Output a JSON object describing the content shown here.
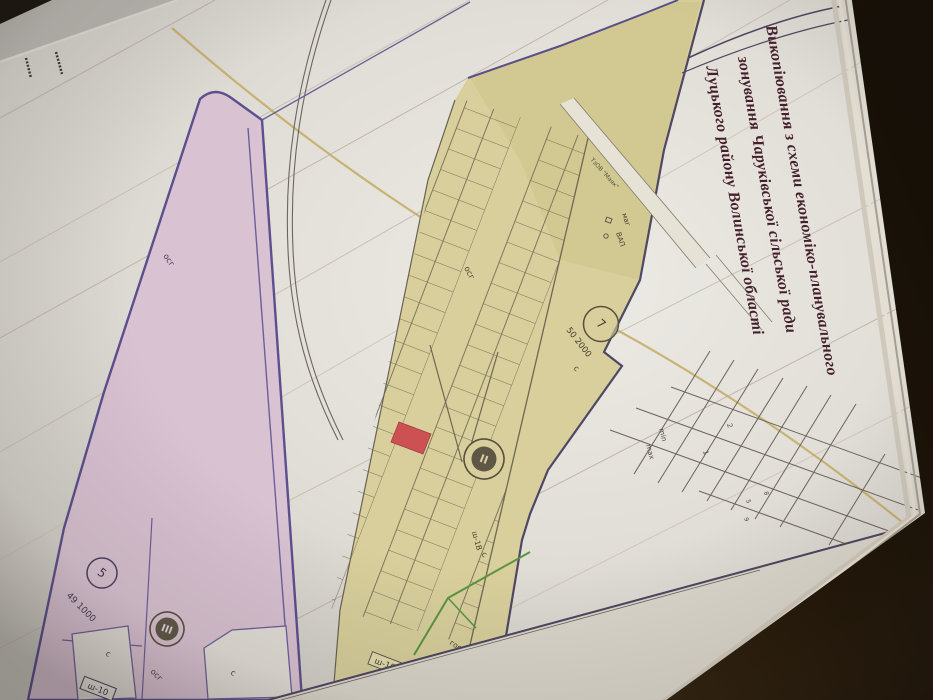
{
  "photo": {
    "table_color": "#21160b",
    "paper_color": "#e7e4de"
  },
  "title_block": {
    "line1": "Викопіювання з схеми економіко-планувального",
    "line2": "зонування Чаруківської сільської ради",
    "line3": "Луцького району Волинської області",
    "text_color": "#44202c"
  },
  "zones": {
    "residential_strip": {
      "fill": "#d9c2d2",
      "border": "#5c4f8e",
      "zone_circle": "5",
      "zone_area": "49 1000",
      "district_circle": "III",
      "labels": {
        "osg_upper": "осг",
        "osg_lower": "осг",
        "parcel_c_left": "с",
        "parcel_c_right": "с",
        "road_box": "ш-10"
      }
    },
    "agricultural_zone": {
      "fill": "#d8cf9c",
      "border": "#554a72",
      "zone_circle": "7",
      "zone_area": "50 2000",
      "district_circle": "II",
      "highlight_parcel_color": "#cd5152",
      "labels": {
        "osg": "осг",
        "c_upper": "с",
        "c_lower": "с",
        "road_box": "ш-10",
        "road_sh1v": "ш-1В",
        "gosp": "госп",
        "mag": "маг",
        "vap": "ВАП",
        "farm_road": "ТзОВ \"Маяк\""
      }
    }
  },
  "setback_table": {
    "row_min": "min",
    "row_max": "max",
    "col_1": "1",
    "col_2": "2",
    "digit_5": "5",
    "digit_8": "8",
    "digit_9": "9"
  }
}
